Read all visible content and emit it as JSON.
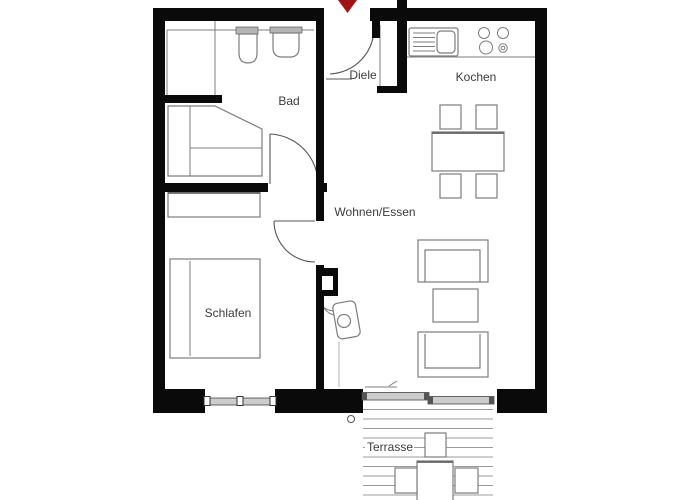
{
  "rooms": {
    "diele": "Diele",
    "bad": "Bad",
    "kochen": "Kochen",
    "wohnen": "Wohnen/Essen",
    "schlafen": "Schlafen",
    "terrasse": "Terrasse"
  },
  "colors": {
    "wall": "#0a0a0a",
    "furniture": "#7d7d7d",
    "text": "#3c3c3c",
    "entrance_arrow": "#9e1414",
    "glass": "#cccccc",
    "background": "#ffffff"
  }
}
